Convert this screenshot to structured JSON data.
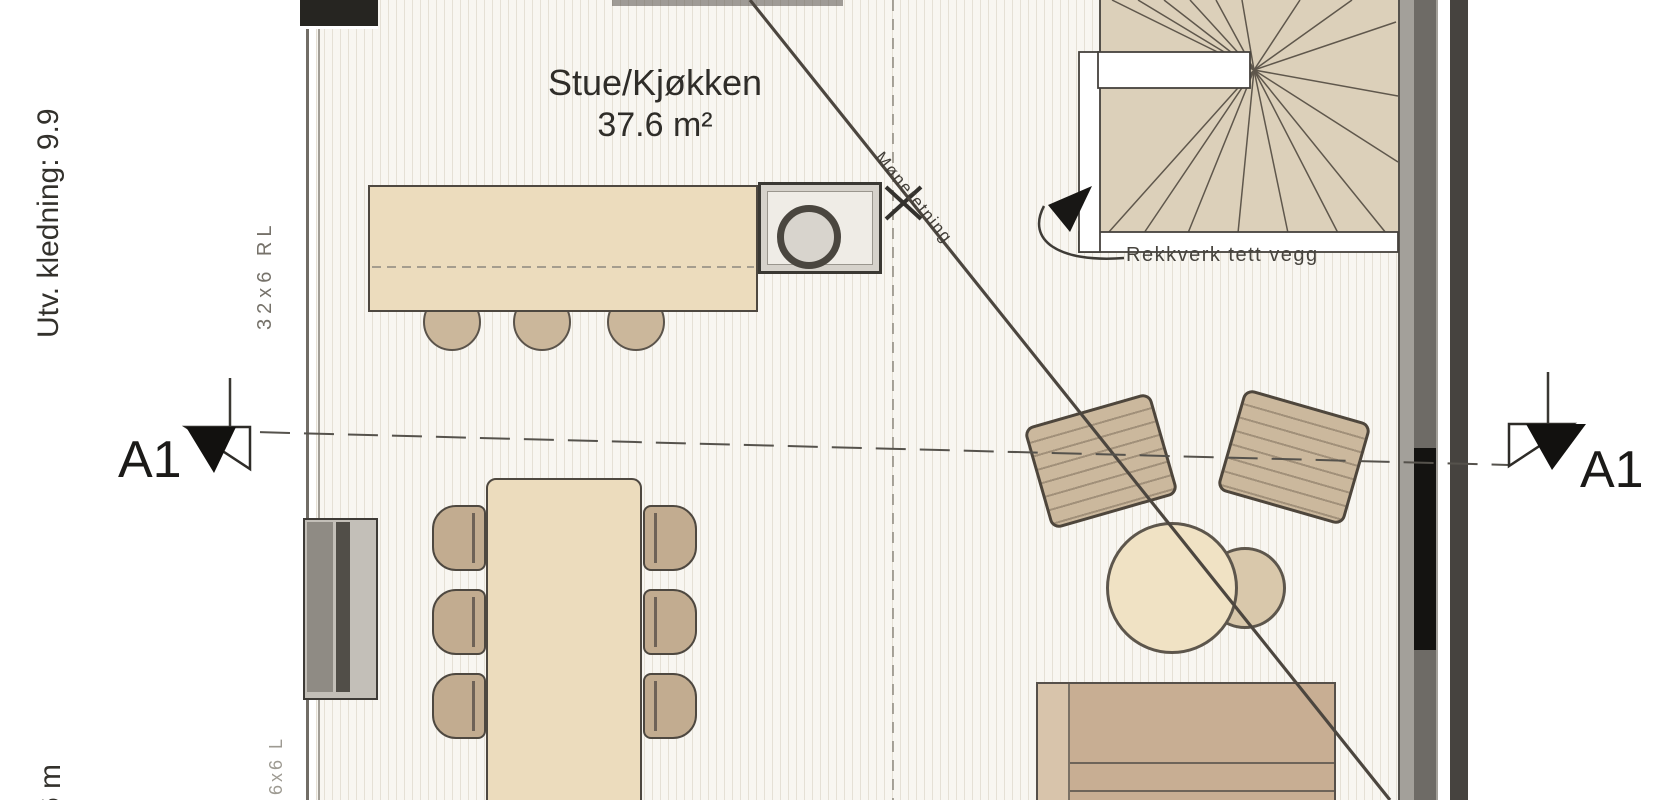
{
  "labels": {
    "room_name": "Stue/Kjøkken",
    "room_area": "37.6 m²",
    "section_left": "A1",
    "section_right": "A1",
    "railing": "Rekkverk tett vegg",
    "ridge_direction": "Møneretning",
    "exterior_cladding": "Utv. kledning: 9.9",
    "bottom_dimension_fragment": "6 m",
    "stud_note_upper": "32x6 RL",
    "stud_note_lower": "6x6 L"
  },
  "colors": {
    "floor_background": "#f8f6f1",
    "floor_stripe": "#e5e0d5",
    "counter_fill": "#ecdcbd",
    "furniture_tan": "#c2ac90",
    "armchair_fill": "#cbb89d",
    "stair_tread": "#dcd0ba",
    "wall_gray": "#a3a09a",
    "wall_black": "#141311",
    "line_dark": "#45423d",
    "text_dark": "#2f2d29"
  }
}
